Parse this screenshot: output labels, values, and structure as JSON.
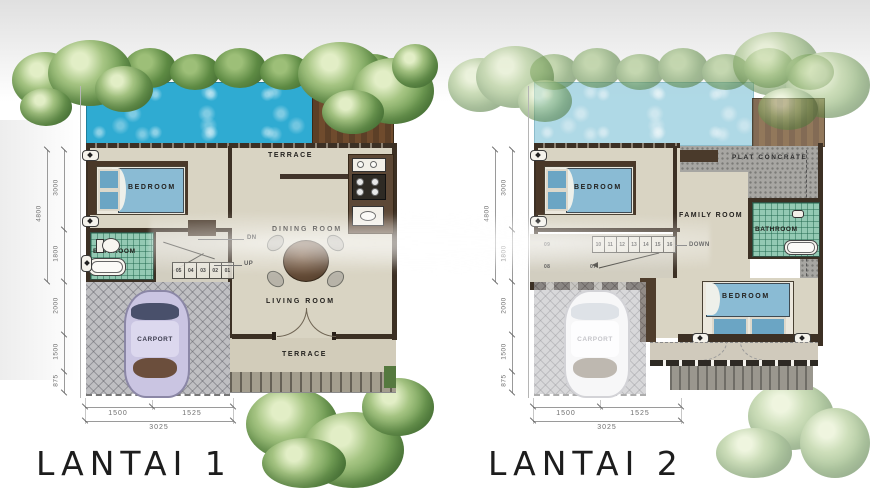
{
  "plans": [
    {
      "title": "LANTAI 1",
      "rooms": {
        "terrace_top": "TERRACE",
        "bedroom": "BEDROOM",
        "dining_room": "DINING ROOM",
        "bathroom": "BATHROOM",
        "living_room": "LIVING ROOM",
        "carport": "CARPORT",
        "terrace_bottom": "TERRACE"
      },
      "stairs": {
        "treads": [
          "05",
          "04",
          "03",
          "02",
          "01"
        ],
        "dn": "DN",
        "up": "UP"
      }
    },
    {
      "title": "LANTAI 2",
      "rooms": {
        "plat_concrete": "PLAT CONCRATE",
        "bedroom_top": "BEDROOM",
        "family_room": "FAMILY ROOM",
        "bathroom": "BATHROOM",
        "bedroom_bottom": "BEDROOM",
        "carport": "CARPORT"
      },
      "stairs": {
        "treads": [
          "10",
          "11",
          "12",
          "13",
          "14",
          "15",
          "16"
        ],
        "marks": [
          "09",
          "08",
          "07"
        ],
        "down": "DOWN"
      }
    }
  ],
  "dimensions": {
    "vertical": {
      "total": "4800",
      "top": "3000",
      "bath": "1800",
      "carport_upper": "2000",
      "carport_lower": "1500",
      "front": "875"
    },
    "horizontal": {
      "left": "1500",
      "right": "1525",
      "total": "3025"
    }
  },
  "colors": {
    "pool": "#2fabd2",
    "pool_faded": "#a9d6e4",
    "bathroom_tile": "#93c9b3",
    "wall_brown": "#3c3024",
    "concrete_gray": "#a7a6a2",
    "floor_beige": "#d9d4c3",
    "bed_blue": "#8abbd4"
  }
}
